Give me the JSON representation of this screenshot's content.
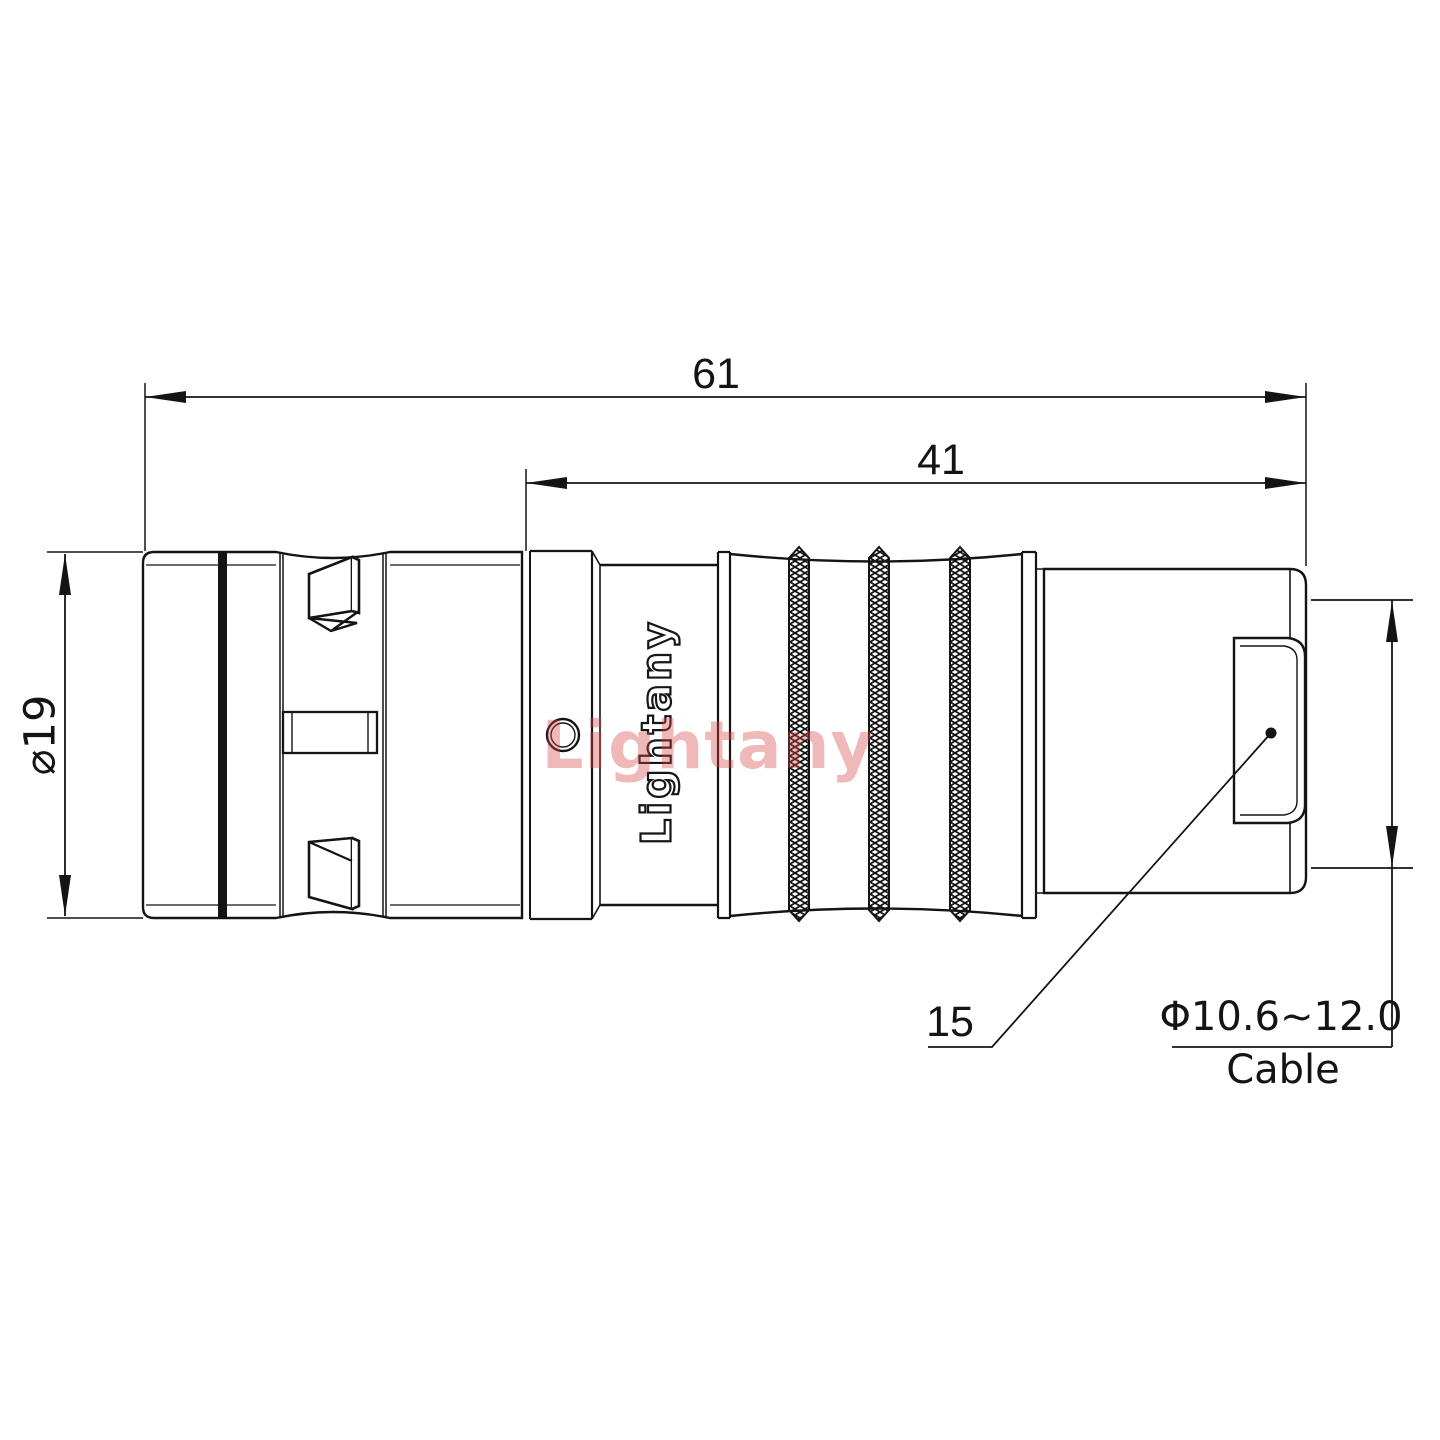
{
  "drawing": {
    "brand_logo": "Lightany",
    "watermark": "Lightany",
    "dim_overall_length": "61",
    "dim_rear_length": "41",
    "dim_body_diameter": "⌀19",
    "leader_ref": "15",
    "cable_spec": "Φ10.6~12.0",
    "cable_caption": "Cable"
  },
  "colors": {
    "line": "#141414",
    "watermark_pink": "rgba(214,70,70,0.38)",
    "background": "#ffffff"
  }
}
